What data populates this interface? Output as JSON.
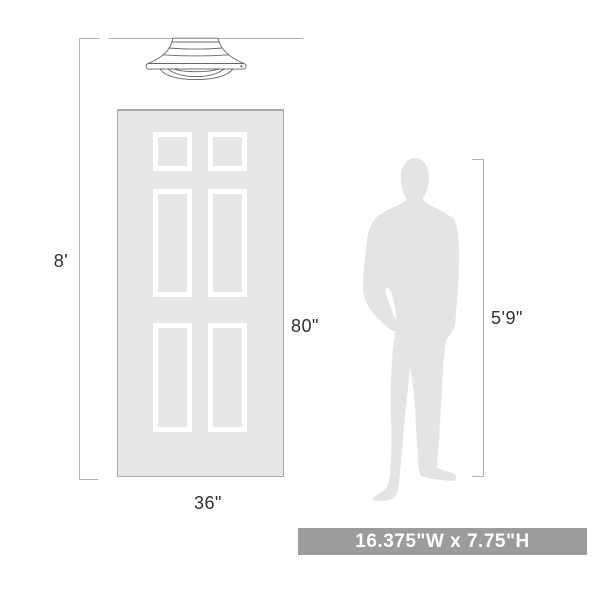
{
  "diagram": {
    "dimensions": {
      "ceiling_height": "8'",
      "door_height": "80\"",
      "door_width": "36\"",
      "person_height": "5'9\""
    },
    "badge": {
      "text": "16.375\"W x 7.75\"H"
    },
    "icons": {
      "fixture": "semi-flush-ceiling-light",
      "door": "six-panel-door",
      "person": "standing-man-silhouette"
    }
  },
  "colors": {
    "background": "#ffffff",
    "line": "#b2b2b2",
    "text": "#303030",
    "door_fill": "#e7e7e7",
    "door_border": "#aaaaaa",
    "panel_frame": "#ffffff",
    "silhouette": "#e4e4e4",
    "fixture_outline": "#666666",
    "badge_bg": "#9c9c9c",
    "badge_text": "#ffffff"
  }
}
